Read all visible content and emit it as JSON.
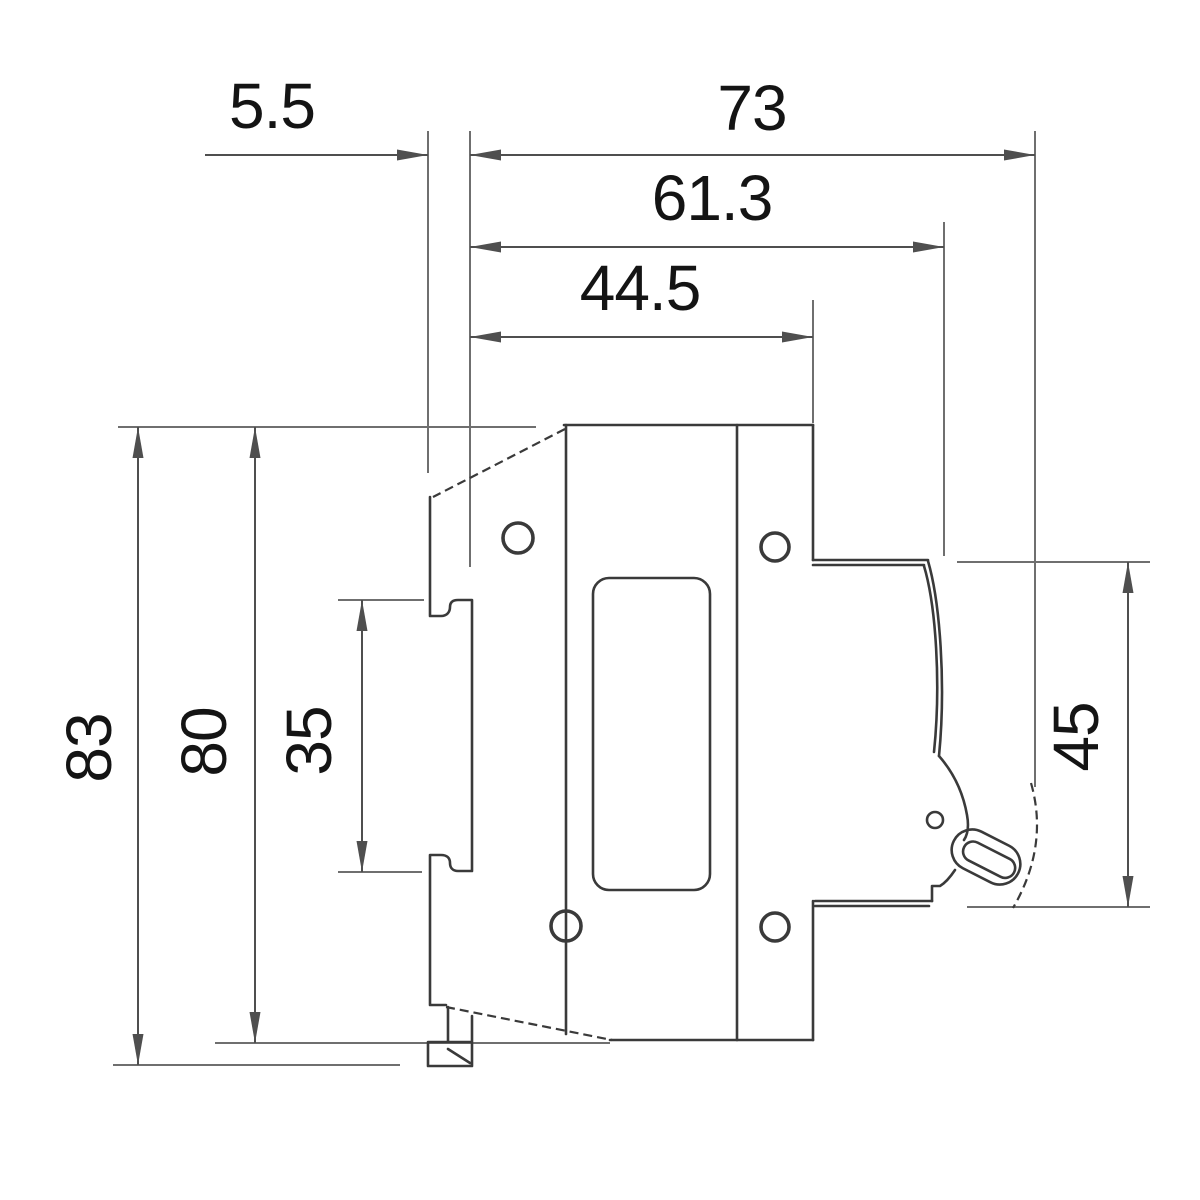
{
  "drawing": {
    "dimensions": {
      "d5_5": "5.5",
      "d73": "73",
      "d61_3": "61.3",
      "d44_5": "44.5",
      "d83": "83",
      "d80": "80",
      "d35": "35",
      "d45": "45"
    },
    "colors": {
      "background": "#ffffff",
      "object_line": "#3a3a3a",
      "dimension_line": "#4f4f4f",
      "extension_line": "#6f6f6f",
      "text": "#141414"
    }
  }
}
